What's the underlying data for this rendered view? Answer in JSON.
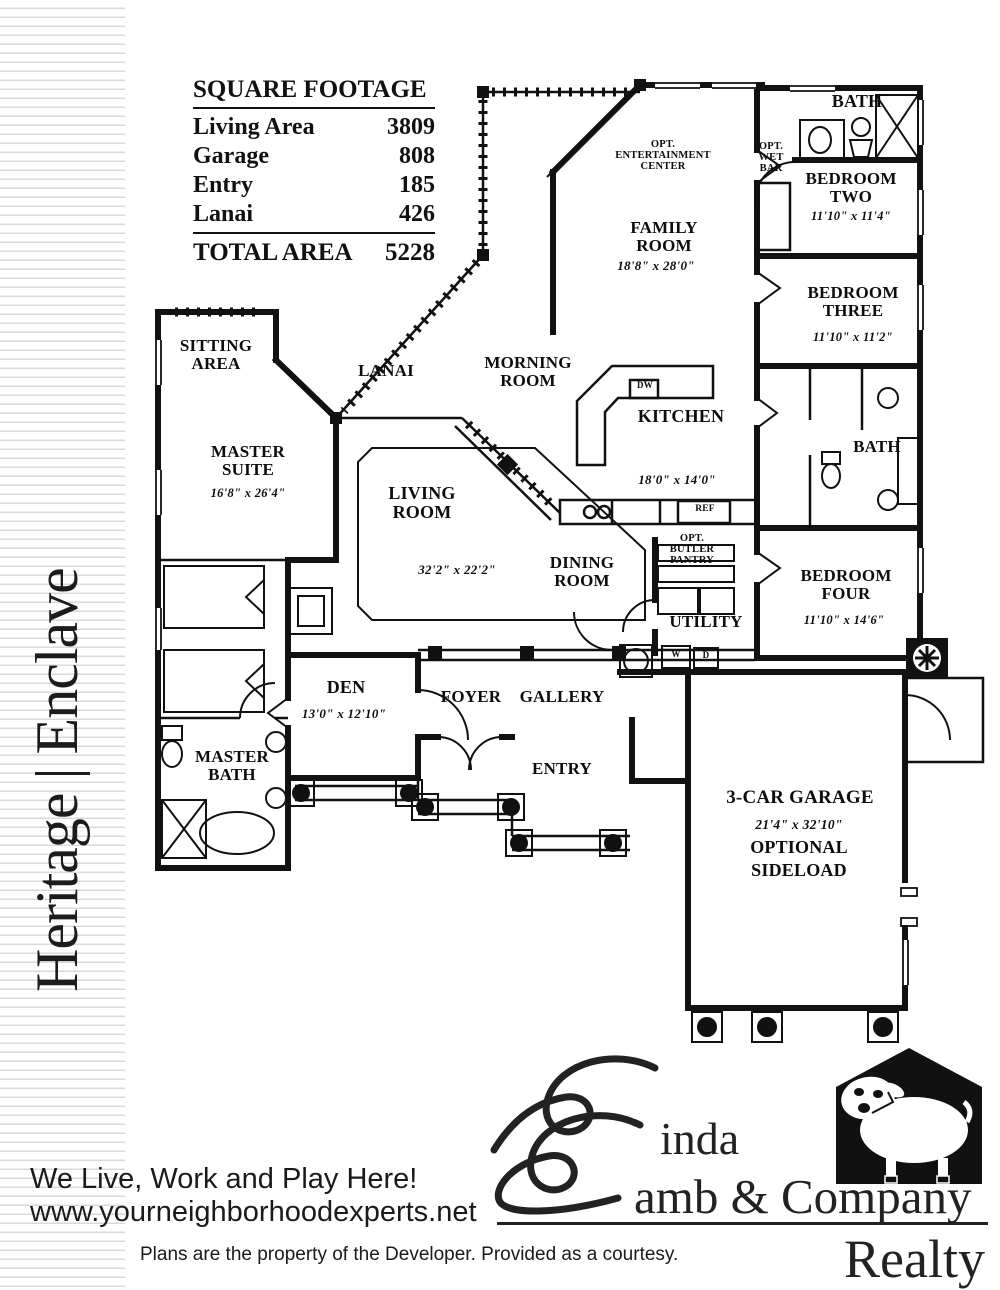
{
  "page": {
    "side_title": "Heritage | Enclave",
    "tagline": "We Live, Work and Play Here!",
    "website": "www.yourneighborhoodexperts.net",
    "disclaimer": "Plans are the property of the Developer.  Provided as a courtesy.",
    "ink_color": "#111111",
    "stripe_color": "#d9d9d9"
  },
  "sqft_table": {
    "title": "SQUARE FOOTAGE",
    "rows": [
      {
        "label": "Living Area",
        "value": "3809"
      },
      {
        "label": "Garage",
        "value": "808"
      },
      {
        "label": "Entry",
        "value": "185"
      },
      {
        "label": "Lanai",
        "value": "426"
      }
    ],
    "total": {
      "label": "TOTAL AREA",
      "value": "5228"
    }
  },
  "floorplan": {
    "rooms": [
      {
        "name": "FAMILY ROOM",
        "dims": "18'8\" x 28'0\""
      },
      {
        "name": "BEDROOM TWO",
        "dims": "11'10\" x 11'4\""
      },
      {
        "name": "BEDROOM THREE",
        "dims": "11'10\" x 11'2\""
      },
      {
        "name": "BATH"
      },
      {
        "name": "OPT. ENTERTAINMENT CENTER"
      },
      {
        "name": "OPT. WET BAR"
      },
      {
        "name": "SITTING AREA"
      },
      {
        "name": "LANAI"
      },
      {
        "name": "MORNING ROOM"
      },
      {
        "name": "KITCHEN",
        "dims": "18'0\" x 14'0\""
      },
      {
        "name": "MASTER SUITE",
        "dims": "16'8\" x 26'4\""
      },
      {
        "name": "LIVING ROOM",
        "dims": "32'2\" x 22'2\""
      },
      {
        "name": "DINING ROOM"
      },
      {
        "name": "OPT. BUTLER PANTRY"
      },
      {
        "name": "UTILITY"
      },
      {
        "name": "BEDROOM FOUR",
        "dims": "11'10\" x 14'6\""
      },
      {
        "name": "BATH"
      },
      {
        "name": "DEN",
        "dims": "13'0\" x 12'10\""
      },
      {
        "name": "FOYER"
      },
      {
        "name": "GALLERY"
      },
      {
        "name": "ENTRY"
      },
      {
        "name": "MASTER BATH"
      },
      {
        "name": "3-CAR GARAGE",
        "dims": "21'4\" x 32'10\"",
        "extra": [
          "OPTIONAL",
          "SIDELOAD"
        ]
      }
    ],
    "appliances": {
      "dishwasher": "DW",
      "refrigerator": "REF",
      "washer": "W",
      "dryer": "D"
    }
  },
  "logo": {
    "monogram": "L",
    "line1": "inda",
    "line2": "amb & Company",
    "division": "Realty"
  }
}
